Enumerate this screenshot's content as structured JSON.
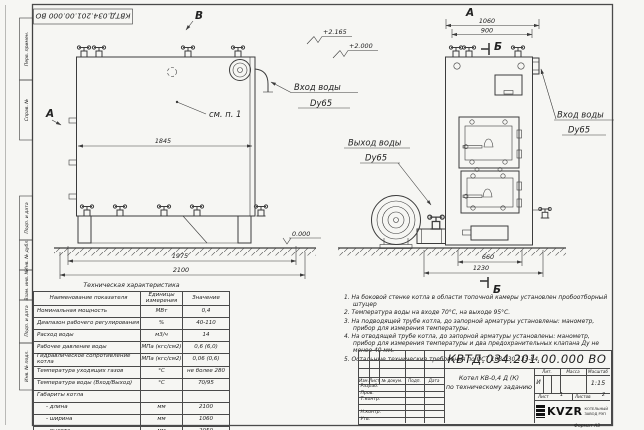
{
  "doc_number": "КВТД.034.201.00.000  ВО",
  "views": {
    "view_b": "В",
    "view_a_side": "А",
    "view_a_front": "А",
    "section_b_top": "Б",
    "section_b_bottom": "Б",
    "see_note": "см. п. 1",
    "inlet_line1": "Вход воды",
    "inlet_line2": "Dy65",
    "inlet_front_line1": "Вход воды",
    "inlet_front_line2": "Dy65",
    "outlet_line1": "Выход воды",
    "outlet_line2": "Dy65",
    "elev_top": "+2.165",
    "elev_mid": "+2.000",
    "elev_zero": "0.000",
    "dim_1845": "1845",
    "dim_1975": "1975",
    "dim_2100": "2100",
    "dim_1060": "1060",
    "dim_900": "900",
    "dim_660": "660",
    "dim_1230": "1230"
  },
  "frame": {
    "sidebar": [
      "Перв. примен.",
      "Справ. №",
      "Подп. и дата",
      "Инв. № дубл.",
      "Взам. инв. №",
      "Подп. и дата",
      "Инв. № подл."
    ]
  },
  "spec_table": {
    "title": "Техническая характеристика",
    "headers": [
      "Наименование показателя",
      "Единицы измерения",
      "Значение"
    ],
    "rows": [
      [
        "Номинальная мощность",
        "МВт",
        "0,4"
      ],
      [
        "Диапазон рабочего регулирования",
        "%",
        "40-110"
      ],
      [
        "Расход воды",
        "м3/ч",
        "14"
      ],
      [
        "Рабочее давление воды",
        "МПа (кгс/см2)",
        "0,6 (6,0)"
      ],
      [
        "Гидравлическое сопротивление котла",
        "МПа (кгс/см2)",
        "0,06 (0,6)"
      ],
      [
        "Температура уходящих газов",
        "°С",
        "не более 280"
      ],
      [
        "Температура воды (Вход/Выход)",
        "°С",
        "70/95"
      ],
      [
        "Габариты котла",
        "",
        ""
      ],
      [
        "- длина",
        "мм",
        "2100"
      ],
      [
        "- ширина",
        "мм",
        "1060"
      ],
      [
        "- высота",
        "мм",
        "2050"
      ]
    ]
  },
  "notes": [
    "1. На боковой стенке котла в области топочной камеры установлен пробоотборный штуцер",
    "2. Температура воды на входе 70°С, на выходе 95°С.",
    "3. На подводящей трубе котла, до запорной арматуры установлены: манометр, прибор для измерения температуры.",
    "4. На отводящей трубе котла, до запорной арматуры установлены: манометр, прибор для измерения температуры и два предохранительных клапана Ду не менее 40 мм.",
    "5. Остальные технические требования по ОСТ 108.030.133-84."
  ],
  "title_block": {
    "header_cols": [
      "Изм.",
      "Лист",
      "№ докум.",
      "Подп.",
      "Дата"
    ],
    "role_rows": [
      "Разраб.",
      "Пров.",
      "Т.контр.",
      "",
      "Н.контр.",
      "Утв."
    ],
    "product_name_line1": "Котел КВ-0,4 Д (К)",
    "product_name_line2": "по техническому заданию",
    "lit_label": "Лит.",
    "mass_label": "Масса",
    "scale_label": "Масштаб",
    "lit_value": "И",
    "scale_value": "1:15",
    "sheet_label": "Лист",
    "sheet_value": "1",
    "sheets_label": "Листов",
    "sheets_value": "2",
    "company_logo": "KVZR",
    "company_line1": "КОТЕЛЬНЫЙ",
    "company_line2": "ЗАВОД РЭП",
    "format_label": "Формат  А3"
  }
}
